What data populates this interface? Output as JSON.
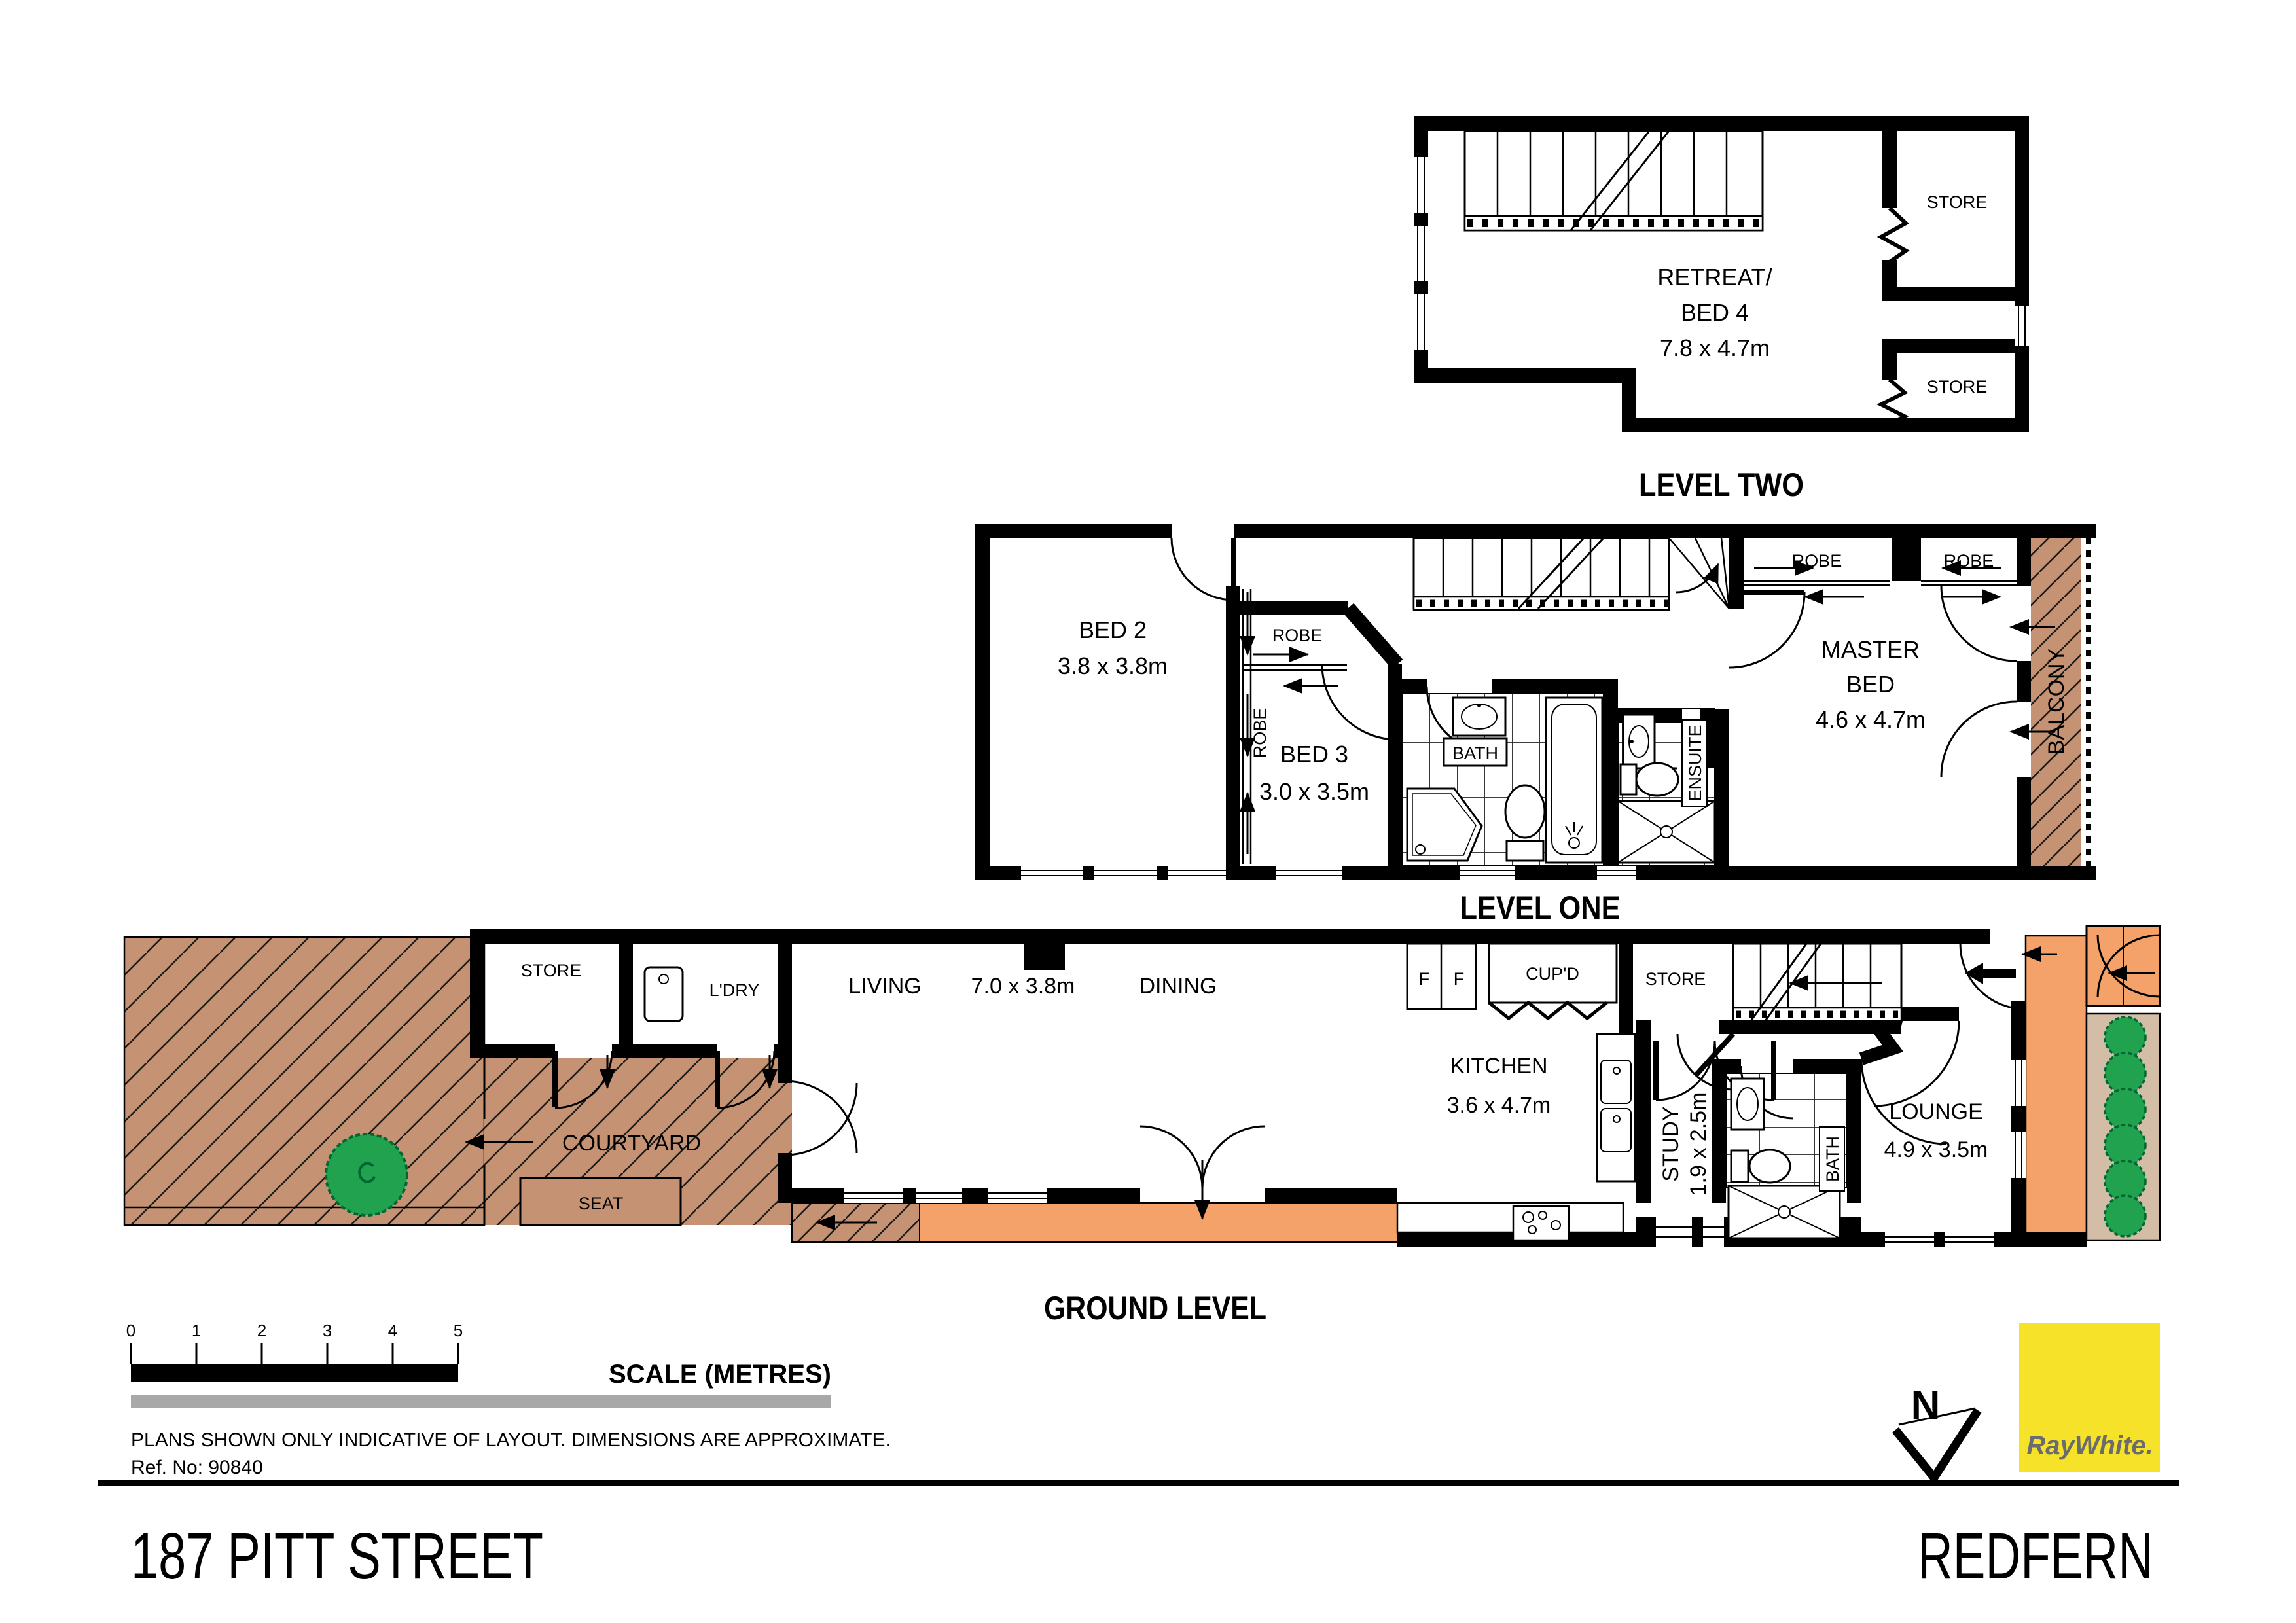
{
  "colors": {
    "hatch_brown": "#C59373",
    "deck_orange": "#F4A269",
    "front_garden_tan": "#D4BDA7",
    "bush_green": "#21A24F",
    "logo_yellow": "#F6E229",
    "logo_text_gray": "#6B6C6E",
    "scale_gray": "#A8A8A8"
  },
  "levels": {
    "level_two": {
      "title": "LEVEL TWO",
      "retreat_line1": "RETREAT/",
      "retreat_line2": "BED 4",
      "retreat_dims": "7.8 x 4.7m",
      "store_upper": "STORE",
      "store_lower": "STORE"
    },
    "level_one": {
      "title": "LEVEL ONE",
      "bed2": "BED 2",
      "bed2_dims": "3.8 x 3.8m",
      "bed3": "BED 3",
      "bed3_dims": "3.0 x 3.5m",
      "robe_bed2": "ROBE",
      "robe_bed3": "ROBE",
      "robe_master_left": "ROBE",
      "robe_master_right": "ROBE",
      "bath": "BATH",
      "ensuite": "ENSUITE",
      "master_line1": "MASTER",
      "master_line2": "BED",
      "master_dims": "4.6 x 4.7m",
      "balcony": "BALCONY"
    },
    "ground": {
      "title": "GROUND LEVEL",
      "store": "STORE",
      "laundry": "L'DRY",
      "courtyard": "COURTYARD",
      "seat": "SEAT",
      "living": "LIVING",
      "living_dims": "7.0 x 3.8m",
      "dining": "DINING",
      "kitchen": "KITCHEN",
      "kitchen_dims": "3.6 x 4.7m",
      "fridge_left": "F",
      "fridge_right": "F",
      "cupboard": "CUP'D",
      "store_understairs": "STORE",
      "study": "STUDY",
      "study_dims": "1.9 x 2.5m",
      "bath": "BATH",
      "lounge": "LOUNGE",
      "lounge_dims": "4.9 x 3.5m"
    }
  },
  "scale_bar": {
    "ticks": [
      "0",
      "1",
      "2",
      "3",
      "4",
      "5"
    ],
    "label": "SCALE (METRES)"
  },
  "notes": {
    "disclaimer": "PLANS SHOWN ONLY INDICATIVE OF LAYOUT.  DIMENSIONS ARE APPROXIMATE.",
    "ref": "Ref. No: 90840"
  },
  "compass": {
    "label": "N"
  },
  "logo": {
    "brand": "RayWhite."
  },
  "footer": {
    "address": "187 PITT STREET",
    "suburb": "REDFERN"
  }
}
